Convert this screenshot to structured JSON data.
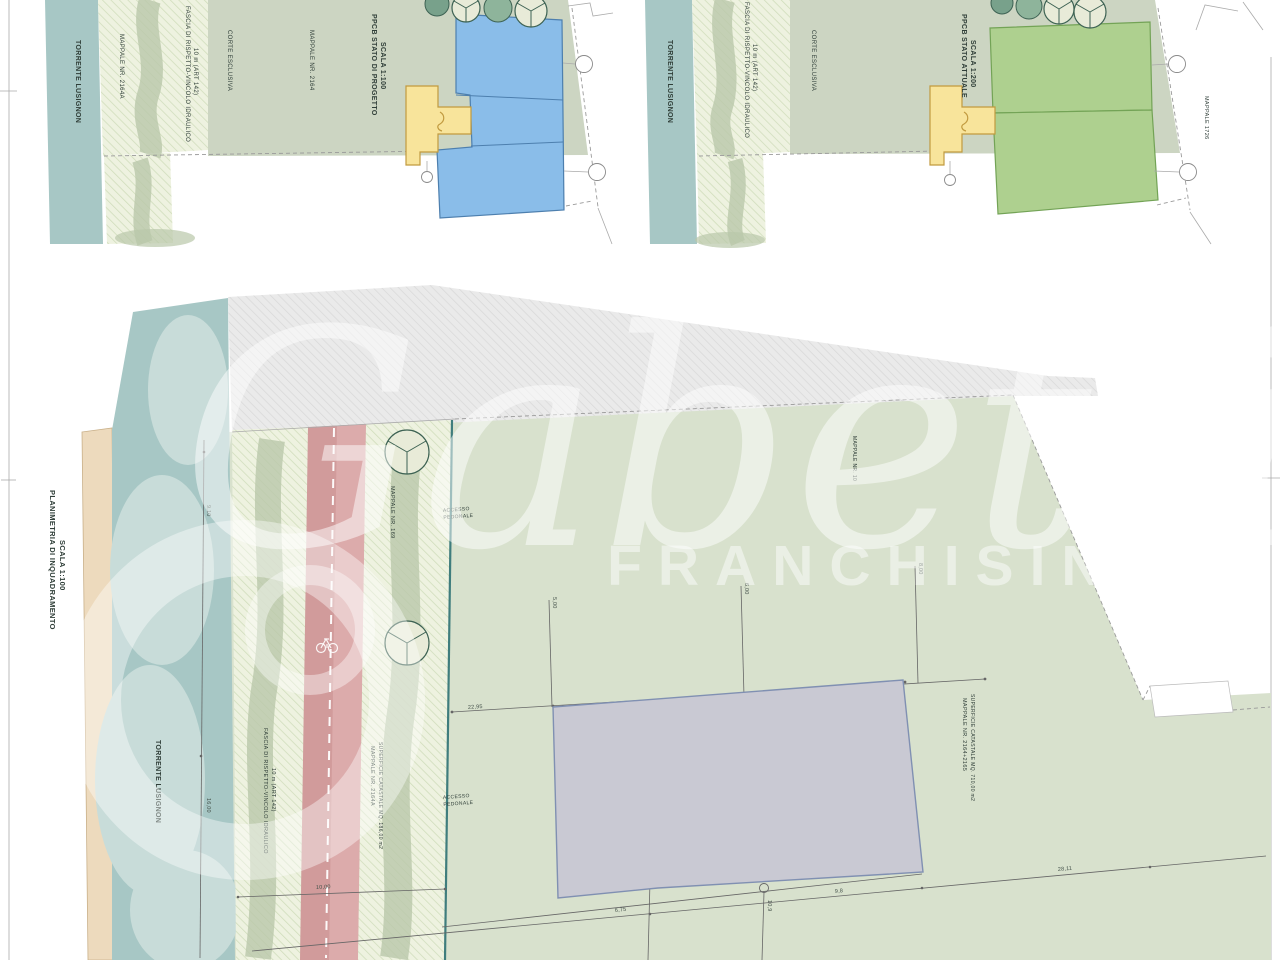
{
  "colors": {
    "river": "#a7c7c5",
    "riverLight": "#c8dcd9",
    "tan": "#eddabd",
    "tanLine": "#c9b089",
    "sage": "#ccd5c2",
    "sageMain": "#d8e1cd",
    "hatchBg": "#eef2e0",
    "hatchLine": "#cfdcba",
    "greyBg": "#eaeaea",
    "greyLine": "#d8d8d8",
    "blob": "#b9c7a9",
    "red": "#d19b9b",
    "redLight": "#dcabab",
    "yellow": "#f8e49b",
    "yellowLine": "#c19a3f",
    "blue": "#8abde9",
    "blueLine": "#4d7fae",
    "green": "#aed08f",
    "greenLine": "#73a356",
    "greyParcel": "#c9c9d3",
    "greyParcelLine": "#8090b2",
    "dashLine": "#9a9a9a",
    "thinLine": "#aaaaaa",
    "dimLine": "#666666",
    "tealLine": "#3f7d7d",
    "treeDark1": "#78a18b",
    "treeDark2": "#8eb49b",
    "treeLight": "#e8ebd8",
    "treeEdge": "#3d6253",
    "text": "#2f3e38"
  },
  "watermark": {
    "brand": "Gabetti",
    "subtitle": "FRANCHISING"
  },
  "panels": {
    "project": {
      "title": "PPCB STATO DI PROGETTO",
      "scale": "SCALA 1:100",
      "torrente": "TORRENTE LUSIGNON",
      "mappale_a": "MAPPALE NR. 2164A",
      "fascia1": "FASCIA DI RISPETTO-VINCOLO IDRAULICO",
      "fascia2": "10 m (ART 142)",
      "corte": "CORTE ESCLUSIVA",
      "mappale": "MAPPALE NR. 2164"
    },
    "attuale": {
      "title": "PPCB STATO ATTUALE",
      "scale": "SCALA 1:200",
      "torrente": "TORRENTE LUSIGNON",
      "fascia1": "FASCIA DI RISPETTO-VINCOLO IDRAULICO",
      "fascia2": "10 m (ART 142)",
      "corte": "CORTE ESCLUSIVA",
      "mappale_1726": "MAPPALE 1726"
    },
    "inquadramento": {
      "title": "PLANIMETRIA DI INQUADRAMENTO",
      "scale": "SCALA 1:100",
      "torrente": "TORRENTE LUSIGNON",
      "fascia1": "FASCIA DI RISPETTO-VINCOLO IDRAULICO",
      "fascia2": "10 m (ART 142)",
      "mappale_169": "MAPPALE NR. 169",
      "mappale_10": "MAPPALE NR. 10",
      "accesso_line1": "ACCESSO",
      "accesso_line2": "PEDONALE",
      "parcel_a1": "MAPPALE NR. 2164A",
      "parcel_a2": "SUPERFICIE CATASTALE MQ. 186,00 m2",
      "parcel_b1": "MAPPALE NR. 2164+2165",
      "parcel_b2": "SUPERFICIE CATASTALE MQ. 710,00 m2",
      "dims": {
        "w1": "9,10",
        "w2": "16,00",
        "w3": "10,00",
        "h1": "5,00",
        "h2": "6,00",
        "h3": "8,00",
        "l1": "22,95",
        "l2": "6,75",
        "l3": "9,8",
        "l4": "10,9",
        "l5": "28,11"
      }
    }
  },
  "icons": {
    "tree": "tree-icon",
    "bicycle": "bicycle-icon"
  }
}
